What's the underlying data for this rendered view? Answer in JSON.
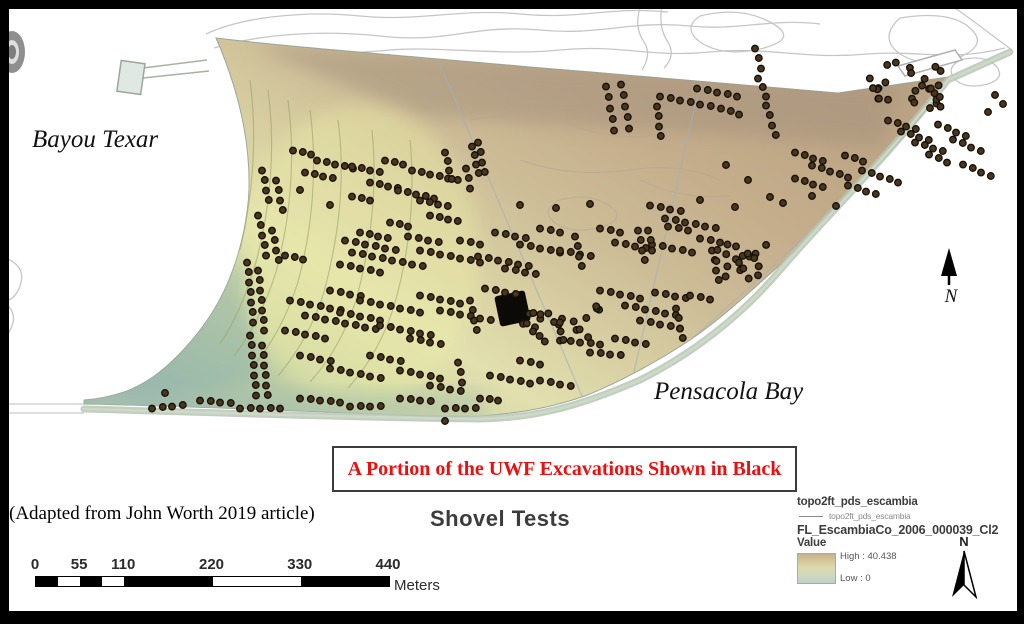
{
  "figure": {
    "title": "Shovel Tests",
    "caption": "A Portion of the UWF Excavations Shown in Black",
    "attribution": "(Adapted from John Worth 2019 article)",
    "water_labels": {
      "bayou": "Bayou Texar",
      "bay": "Pensacola Bay"
    },
    "north_letter": "N"
  },
  "scalebar": {
    "ticks": [
      {
        "label": "0",
        "fraction": 0
      },
      {
        "label": "55",
        "fraction": 0.125
      },
      {
        "label": "110",
        "fraction": 0.25
      },
      {
        "label": "220",
        "fraction": 0.5
      },
      {
        "label": "330",
        "fraction": 0.75
      },
      {
        "label": "440",
        "fraction": 1
      }
    ],
    "breaks": [
      0,
      27.5,
      55,
      82.5,
      110,
      220,
      330,
      440
    ],
    "max": 440,
    "unit": "Meters",
    "colors": [
      "#000000",
      "#ffffff"
    ]
  },
  "legend": {
    "layer1": "topo2ft_pds_escambia",
    "layer1_sub": "topo2ft_pds_escambia",
    "layer2": "FL_EscambiaCo_2006_000039_Cl2",
    "value_label": "Value",
    "high": "High : 40.438",
    "low": "Low : 0",
    "north_letter": "N"
  },
  "colors": {
    "caption_red": "#ed0e0e",
    "dot_fill": "#4a3620",
    "dot_stroke": "#151007",
    "elevation_high": "#c3a783",
    "elevation_low": "#9fbab0",
    "contour_gray": "#c6c6c6"
  },
  "map_data": {
    "dot_style": {
      "radius": 3.3,
      "stroke_width": 1.3
    },
    "excavation_block": {
      "x": 497,
      "y": 293,
      "w": 31,
      "h": 31,
      "rotate": -12
    },
    "dot_runs": [
      [
        606,
        86,
        2,
        11,
        5
      ],
      [
        621,
        84,
        2,
        11,
        5
      ],
      [
        660,
        96,
        10,
        2,
        6
      ],
      [
        657,
        106,
        1,
        10,
        4
      ],
      [
        697,
        88,
        10,
        2,
        5
      ],
      [
        721,
        108,
        9,
        3,
        3
      ],
      [
        888,
        120,
        9,
        3,
        4
      ],
      [
        901,
        131,
        9,
        3,
        4
      ],
      [
        915,
        142,
        9,
        3,
        4
      ],
      [
        938,
        124,
        9,
        4,
        4
      ],
      [
        953,
        139,
        9,
        4,
        4
      ],
      [
        929,
        154,
        9,
        4,
        3
      ],
      [
        963,
        164,
        9,
        4,
        4
      ],
      [
        293,
        150,
        9,
        2,
        3
      ],
      [
        317,
        160,
        9,
        2,
        5
      ],
      [
        305,
        172,
        9,
        2,
        4
      ],
      [
        352,
        166,
        9,
        2,
        4
      ],
      [
        385,
        160,
        9,
        2,
        3
      ],
      [
        412,
        170,
        9,
        2,
        6
      ],
      [
        370,
        182,
        9,
        2,
        4
      ],
      [
        398,
        190,
        9,
        2,
        5
      ],
      [
        352,
        196,
        9,
        2,
        3
      ],
      [
        420,
        200,
        9,
        2,
        4
      ],
      [
        445,
        152,
        2,
        9,
        4
      ],
      [
        472,
        146,
        2,
        9,
        4
      ],
      [
        430,
        215,
        9,
        2,
        4
      ],
      [
        390,
        222,
        9,
        2,
        3
      ],
      [
        360,
        232,
        9,
        2,
        4
      ],
      [
        262,
        170,
        2,
        10,
        4
      ],
      [
        276,
        180,
        2,
        10,
        4
      ],
      [
        258,
        215,
        2,
        10,
        5
      ],
      [
        272,
        230,
        2,
        10,
        4
      ],
      [
        285,
        255,
        9,
        2,
        3
      ],
      [
        247,
        262,
        1,
        10,
        7
      ],
      [
        258,
        270,
        1,
        10,
        7
      ],
      [
        250,
        335,
        1,
        10,
        7
      ],
      [
        262,
        345,
        1,
        10,
        6
      ],
      [
        345,
        240,
        10,
        2,
        6
      ],
      [
        352,
        252,
        10,
        2,
        8
      ],
      [
        340,
        264,
        10,
        2,
        5
      ],
      [
        408,
        236,
        10,
        2,
        4
      ],
      [
        420,
        250,
        10,
        2,
        7
      ],
      [
        460,
        240,
        10,
        2,
        3
      ],
      [
        495,
        232,
        10,
        2,
        4
      ],
      [
        520,
        244,
        10,
        2,
        5
      ],
      [
        478,
        256,
        10,
        2,
        6
      ],
      [
        505,
        268,
        10,
        2,
        4
      ],
      [
        540,
        228,
        10,
        2,
        3
      ],
      [
        560,
        250,
        10,
        2,
        4
      ],
      [
        575,
        236,
        2,
        10,
        4
      ],
      [
        600,
        228,
        10,
        2,
        3
      ],
      [
        615,
        242,
        10,
        2,
        4
      ],
      [
        638,
        230,
        2,
        10,
        4
      ],
      [
        652,
        244,
        10,
        2,
        5
      ],
      [
        668,
        226,
        10,
        2,
        3
      ],
      [
        478,
        142,
        2,
        10,
        4
      ],
      [
        466,
        168,
        2,
        10,
        3
      ],
      [
        290,
        300,
        10,
        2,
        6
      ],
      [
        305,
        315,
        10,
        2,
        8
      ],
      [
        285,
        330,
        10,
        2,
        5
      ],
      [
        330,
        290,
        10,
        2,
        4
      ],
      [
        360,
        300,
        10,
        2,
        7
      ],
      [
        340,
        312,
        10,
        2,
        5
      ],
      [
        380,
        325,
        10,
        2,
        6
      ],
      [
        420,
        295,
        10,
        2,
        5
      ],
      [
        440,
        310,
        10,
        2,
        6
      ],
      [
        410,
        338,
        10,
        2,
        4
      ],
      [
        470,
        300,
        2,
        10,
        4
      ],
      [
        485,
        288,
        10,
        2,
        4
      ],
      [
        600,
        290,
        10,
        2,
        5
      ],
      [
        625,
        305,
        10,
        2,
        6
      ],
      [
        655,
        292,
        10,
        2,
        4
      ],
      [
        640,
        320,
        10,
        2,
        5
      ],
      [
        676,
        308,
        2,
        10,
        4
      ],
      [
        690,
        295,
        10,
        2,
        3
      ],
      [
        700,
        238,
        10,
        2,
        3
      ],
      [
        712,
        250,
        2,
        10,
        4
      ],
      [
        795,
        152,
        9,
        3,
        4
      ],
      [
        812,
        165,
        9,
        3,
        5
      ],
      [
        795,
        178,
        9,
        3,
        4
      ],
      [
        845,
        155,
        9,
        3,
        3
      ],
      [
        862,
        170,
        9,
        3,
        5
      ],
      [
        848,
        185,
        9,
        3,
        4
      ],
      [
        650,
        205,
        10,
        2,
        4
      ],
      [
        665,
        218,
        10,
        2,
        6
      ],
      [
        648,
        230,
        2,
        10,
        3
      ],
      [
        300,
        355,
        10,
        2,
        4
      ],
      [
        330,
        368,
        10,
        2,
        6
      ],
      [
        370,
        355,
        10,
        2,
        4
      ],
      [
        400,
        370,
        10,
        2,
        5
      ],
      [
        430,
        385,
        10,
        2,
        4
      ],
      [
        458,
        362,
        2,
        10,
        3
      ],
      [
        490,
        375,
        10,
        2,
        5
      ],
      [
        520,
        360,
        10,
        2,
        3
      ],
      [
        540,
        380,
        10,
        2,
        4
      ],
      [
        152,
        408,
        10,
        -1,
        4
      ],
      [
        200,
        400,
        10,
        1,
        4
      ],
      [
        240,
        408,
        10,
        0,
        5
      ],
      [
        300,
        398,
        10,
        1,
        5
      ],
      [
        350,
        406,
        10,
        0,
        4
      ],
      [
        400,
        398,
        10,
        1,
        4
      ],
      [
        445,
        408,
        10,
        0,
        4
      ],
      [
        480,
        398,
        9,
        1,
        3
      ],
      [
        560,
        340,
        10,
        1,
        5
      ],
      [
        590,
        352,
        10,
        1,
        4
      ],
      [
        615,
        338,
        10,
        2,
        4
      ],
      [
        755,
        48,
        3,
        10,
        3
      ],
      [
        758,
        78,
        4,
        9,
        3
      ],
      [
        766,
        105,
        3,
        10,
        4
      ]
    ],
    "dot_blobs": [
      [
        905,
        85,
        36,
        24,
        28
      ],
      [
        560,
        322,
        40,
        20,
        26
      ],
      [
        742,
        262,
        26,
        20,
        20
      ]
    ],
    "dot_points": [
      [
        700,
        200
      ],
      [
        735,
        207
      ],
      [
        770,
        197
      ],
      [
        783,
        203
      ],
      [
        812,
        196
      ],
      [
        836,
        206
      ],
      [
        300,
        190
      ],
      [
        330,
        205
      ],
      [
        445,
        421
      ],
      [
        165,
        393
      ],
      [
        520,
        205
      ],
      [
        556,
        208
      ],
      [
        590,
        204
      ],
      [
        726,
        165
      ],
      [
        748,
        180
      ],
      [
        995,
        95
      ],
      [
        1003,
        104
      ],
      [
        988,
        112
      ]
    ]
  }
}
